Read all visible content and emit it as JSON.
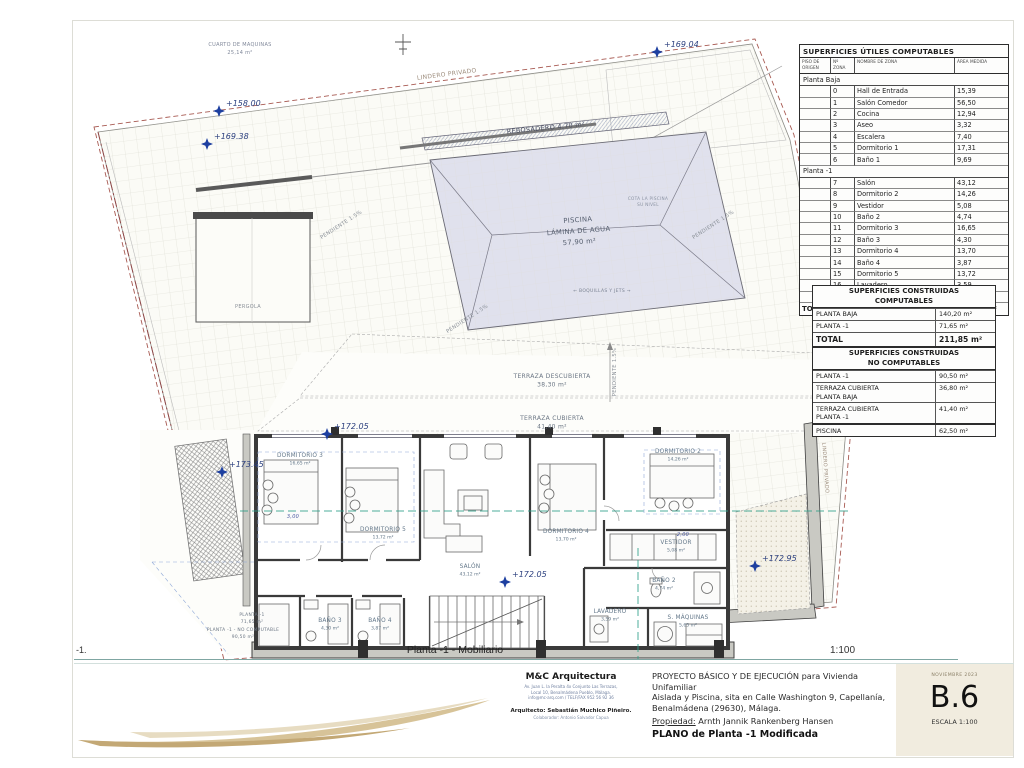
{
  "footer": {
    "left_marker": "-1.",
    "plan_title": "Planta -1 - Mobiliario",
    "scale": "1:100"
  },
  "tables": {
    "useful": {
      "title": "SUPERFICIES ÚTILES COMPUTABLES",
      "col_headers": [
        "PISO DE ORIGEN",
        "Nº ZONA",
        "NOMBRE DE ZONA",
        "ÁREA MEDIDA"
      ],
      "sections": [
        {
          "name": "Planta Baja",
          "rows": [
            {
              "zone": "0",
              "name": "Hall de Entrada",
              "area": "15,39"
            },
            {
              "zone": "1",
              "name": "Salón Comedor",
              "area": "56,50"
            },
            {
              "zone": "2",
              "name": "Cocina",
              "area": "12,94"
            },
            {
              "zone": "3",
              "name": "Aseo",
              "area": "3,32"
            },
            {
              "zone": "4",
              "name": "Escalera",
              "area": "7,40"
            },
            {
              "zone": "5",
              "name": "Dormitorio 1",
              "area": "17,31"
            },
            {
              "zone": "6",
              "name": "Baño 1",
              "area": "9,69"
            }
          ]
        },
        {
          "name": "Planta -1",
          "rows": [
            {
              "zone": "7",
              "name": "Salón",
              "area": "43,12"
            },
            {
              "zone": "8",
              "name": "Dormitorio 2",
              "area": "14,26"
            },
            {
              "zone": "9",
              "name": "Vestidor",
              "area": "5,08"
            },
            {
              "zone": "10",
              "name": "Baño 2",
              "area": "4,74"
            },
            {
              "zone": "11",
              "name": "Dormitorio 3",
              "area": "16,65"
            },
            {
              "zone": "12",
              "name": "Baño 3",
              "area": "4,30"
            },
            {
              "zone": "13",
              "name": "Dormitorio 4",
              "area": "13,70"
            },
            {
              "zone": "14",
              "name": "Baño 4",
              "area": "3,87"
            },
            {
              "zone": "15",
              "name": "Dormitorio 5",
              "area": "13,72"
            },
            {
              "zone": "16",
              "name": "Lavadero",
              "area": "3,59"
            },
            {
              "zone": "17",
              "name": "S.Máquinas",
              "area": "5,65"
            }
          ]
        }
      ],
      "total_label": "TOTAL",
      "total_value": "251,23 m²"
    },
    "built_computable": {
      "title": [
        "SUPERFICIES CONSTRUIDAS",
        "COMPUTABLES"
      ],
      "rows": [
        {
          "label": "PLANTA BAJA",
          "value": "140,20 m²"
        },
        {
          "label": "PLANTA -1",
          "value": "71,65 m²"
        }
      ],
      "total": {
        "label": "TOTAL",
        "value": "211,85 m²"
      }
    },
    "built_non_computable": {
      "title": [
        "SUPERFICIES CONSTRUIDAS",
        "NO COMPUTABLES"
      ],
      "rows": [
        {
          "label": "PLANTA -1",
          "value": "90,50 m²"
        },
        {
          "label": "TERRAZA CUBIERTA\nPLANTA BAJA",
          "value": "36,80 m²"
        },
        {
          "label": "TERRAZA CUBIERTA\nPLANTA -1",
          "value": "41,40 m²"
        }
      ]
    },
    "piscina": {
      "label": "PISCINA",
      "value": "62,50 m²"
    }
  },
  "plan": {
    "rooms": [
      {
        "id": "dormitorio-3",
        "name": "DORMITORIO 3",
        "area": "16,65 m²"
      },
      {
        "id": "dormitorio-5",
        "name": "DORMITORIO 5",
        "area": "13,72 m²"
      },
      {
        "id": "salon",
        "name": "SALÓN",
        "area": "43,12 m²"
      },
      {
        "id": "dormitorio-4",
        "name": "DORMITORIO 4",
        "area": "13,70 m²"
      },
      {
        "id": "dormitorio-2",
        "name": "DORMITORIO 2",
        "area": "14,26 m²"
      },
      {
        "id": "vestidor",
        "name": "VESTIDOR",
        "area": "5,08 m²"
      },
      {
        "id": "bano-2",
        "name": "BAÑO 2",
        "area": "4,74 m²"
      },
      {
        "id": "lavadero",
        "name": "LAVADERO",
        "area": "3,59 m²"
      },
      {
        "id": "s-maquinas",
        "name": "S. MÁQUINAS",
        "area": "5,65 m²"
      },
      {
        "id": "bano-3",
        "name": "BAÑO 3",
        "area": "4,30 m²"
      },
      {
        "id": "bano-4",
        "name": "BAÑO 4",
        "area": "3,87 m²"
      }
    ],
    "elevations": [
      {
        "id": "el-158-00",
        "value": "+158.00"
      },
      {
        "id": "el-169-38",
        "value": "+169.38"
      },
      {
        "id": "el-169-04",
        "value": "+169.04"
      },
      {
        "id": "el-172-05-a",
        "value": "+172.05"
      },
      {
        "id": "el-172-05-b",
        "value": "+172.05"
      },
      {
        "id": "el-173-45",
        "value": "+173.45"
      },
      {
        "id": "el-172-95",
        "value": "+172.95"
      }
    ],
    "labels": [
      {
        "id": "cuarto-maquinas",
        "lines": [
          "CUARTO DE MAQUINAS",
          "25,14 m²"
        ]
      },
      {
        "id": "lindero-top",
        "lines": [
          "LINDERO PRIVADO"
        ]
      },
      {
        "id": "lindero-right",
        "lines": [
          "LINDERO PRIVADO"
        ]
      },
      {
        "id": "rebosadero",
        "lines": [
          "REBOSADERO 4,70 m²"
        ]
      },
      {
        "id": "piscina",
        "lines": [
          "PISCINA",
          "LÁMINA DE AGUA",
          "57,90 m²"
        ]
      },
      {
        "id": "pool-note",
        "lines": [
          "COTA LA PISCINA",
          "SU NIVEL"
        ]
      },
      {
        "id": "jets",
        "lines": [
          "← BOQUILLAS Y JETS →"
        ]
      },
      {
        "id": "pendiente-1",
        "lines": [
          "PENDIENTE 1.5%"
        ]
      },
      {
        "id": "pendiente-2",
        "lines": [
          "PENDIENTE 1.5%"
        ]
      },
      {
        "id": "pendiente-3",
        "lines": [
          "PENDIENTE 1.5%"
        ]
      },
      {
        "id": "pendiente-4",
        "lines": [
          "PENDIENTE 1.5%"
        ]
      },
      {
        "id": "terraza-descubierta",
        "lines": [
          "TERRAZA DESCUBIERTA",
          "38,30 m²"
        ]
      },
      {
        "id": "terraza-cubierta",
        "lines": [
          "TERRAZA CUBIERTA",
          "41,40 m²"
        ]
      },
      {
        "id": "pergola",
        "lines": [
          "PERGOLA"
        ]
      },
      {
        "id": "planta-1",
        "lines": [
          "PLANTA -1",
          "71,65 m²"
        ]
      },
      {
        "id": "planta-1-nc",
        "lines": [
          "PLANTA -1 - NO COMPUTABLE",
          "90,50 m²"
        ]
      },
      {
        "id": "dim-3-00",
        "lines": [
          "3,00"
        ]
      },
      {
        "id": "dim-2-00",
        "lines": [
          "2,00"
        ]
      }
    ]
  },
  "titleblock": {
    "firm_name": "M&C Arquitectura",
    "addr1": "Av. Juan L. la Peralta 4x Conjunto Las Terrazas,",
    "addr2": "Local 10, Benalmádena Pueblo, Málaga.",
    "addr3": "info@mc-arq.com / TELF/FAX 952 56 92 36",
    "architect": "Arquitecto: Sebastián Muchico Piñeiro.",
    "collaborator": "Colaborador: Antonio Salvador Capua",
    "project_line1": "PROYECTO BÁSICO Y DE EJECUCIÓN para Vivienda Unifamiliar",
    "project_line2": "Aislada y Piscina, sita en Calle Washington 9, Capellanía,",
    "project_line3": "Benalmádena (29630), Málaga.",
    "owner_label": "Propiedad:",
    "owner_name": "Arnth Jannik Rankenberg Hansen",
    "plan_line": "PLANO de Planta -1 Modificada",
    "date": "NOVIEMBRE 2023",
    "sheet_number": "B.6",
    "scale_label": "ESCALA 1:100"
  },
  "colors": {
    "boundary_red": "#a85a52",
    "section_teal": "#2fa08a",
    "elevation_blue": "#1d3fa0",
    "label_gray": "#64788a",
    "swoosh_tan": "#d7c398",
    "stamp_cream": "#f1ecdf"
  }
}
